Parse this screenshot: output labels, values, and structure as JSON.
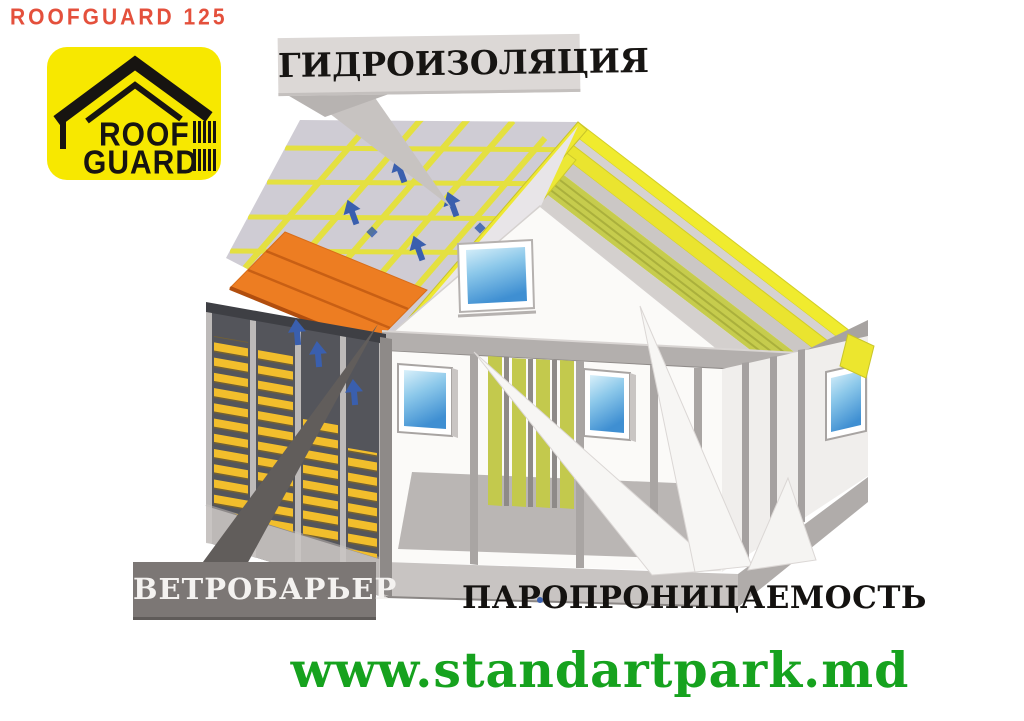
{
  "page": {
    "width": 1024,
    "height": 721,
    "background": "#ffffff"
  },
  "brand": {
    "text": "ROOFGUARD 125",
    "color": "#e4503c"
  },
  "logo": {
    "line1": "ROOF",
    "line2": "GUARD",
    "background": "#f7e800",
    "foreground": "#171411"
  },
  "diagram": {
    "label_waterproofing": "ГИДРОИЗОЛЯЦИЯ",
    "label_wind_barrier": "ВЕТРОБАРЬЕР",
    "label_vapor_permeability": "ПАРОПРОНИЦАЕМОСТЬ",
    "colors": {
      "membrane_gray": "#cfccd4",
      "battens_yellow": "#e4e040",
      "roof_tiles_orange": "#ed7d22",
      "rafters_yellow": "#f0eb2e",
      "insulation_green": "#c6cc4d",
      "siding_yellow": "#f2be2c",
      "wind_membrane_dark": "#54555b",
      "vapor_arrow_blue": "#3a5fae",
      "waterproofing_label_bg": "#dcd8d6",
      "wind_label_bg": "#7c7775",
      "vapor_label_color": "#141210"
    }
  },
  "footer": {
    "website": "www.standartpark.md",
    "color": "#16a21e"
  }
}
